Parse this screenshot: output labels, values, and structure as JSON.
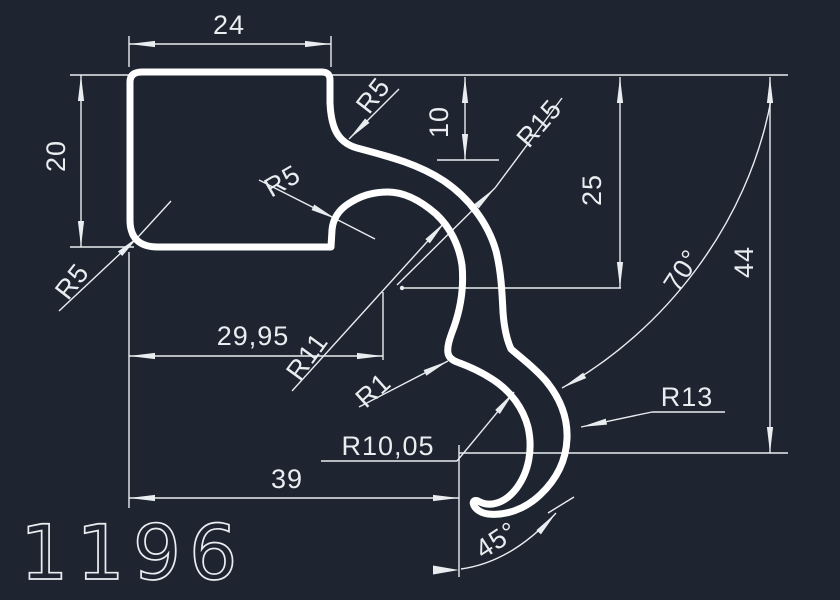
{
  "drawing_number": "1196",
  "canvas": {
    "background_color": "#1e2430",
    "profile_line_color": "#ffffff",
    "dimension_color": "#e9edf0"
  },
  "dims": {
    "d24": "24",
    "d20": "20",
    "d10": "10",
    "d25": "25",
    "d44": "44",
    "d2995": "29,95",
    "d39": "39"
  },
  "radii": {
    "r5_top": "R5",
    "r5_mid": "R5",
    "r5_corner": "R5",
    "r15": "R15",
    "r11": "R11",
    "r1": "R1",
    "r1005": "R10,05",
    "r13": "R13"
  },
  "angles": {
    "a70": "70°",
    "a45": "45°"
  }
}
